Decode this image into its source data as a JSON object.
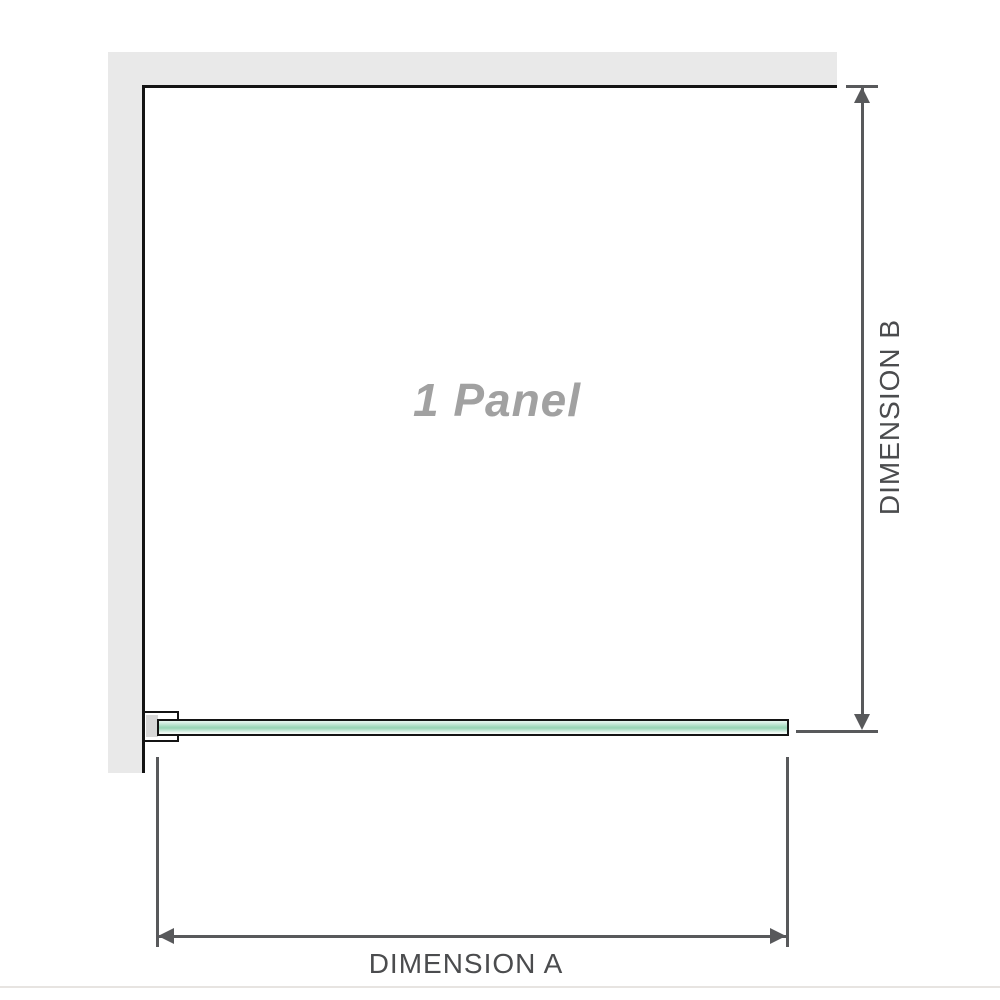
{
  "diagram": {
    "panel_label": "1 Panel",
    "dimension_a_label": "DIMENSION A",
    "dimension_b_label": "DIMENSION B"
  },
  "colors": {
    "background": "#ffffff",
    "wall": "#e9e9e9",
    "edge": "#141414",
    "dim": "#58595b",
    "label": "#4b4c4e",
    "panel-label": "#a1a1a1",
    "bracket-inner": "#d7d7d7",
    "glass-light": "#e2f4ec",
    "glass-mid": "#9bd6b8",
    "glass-pale": "#f2faf6",
    "baseline": "#e7e4e1"
  }
}
